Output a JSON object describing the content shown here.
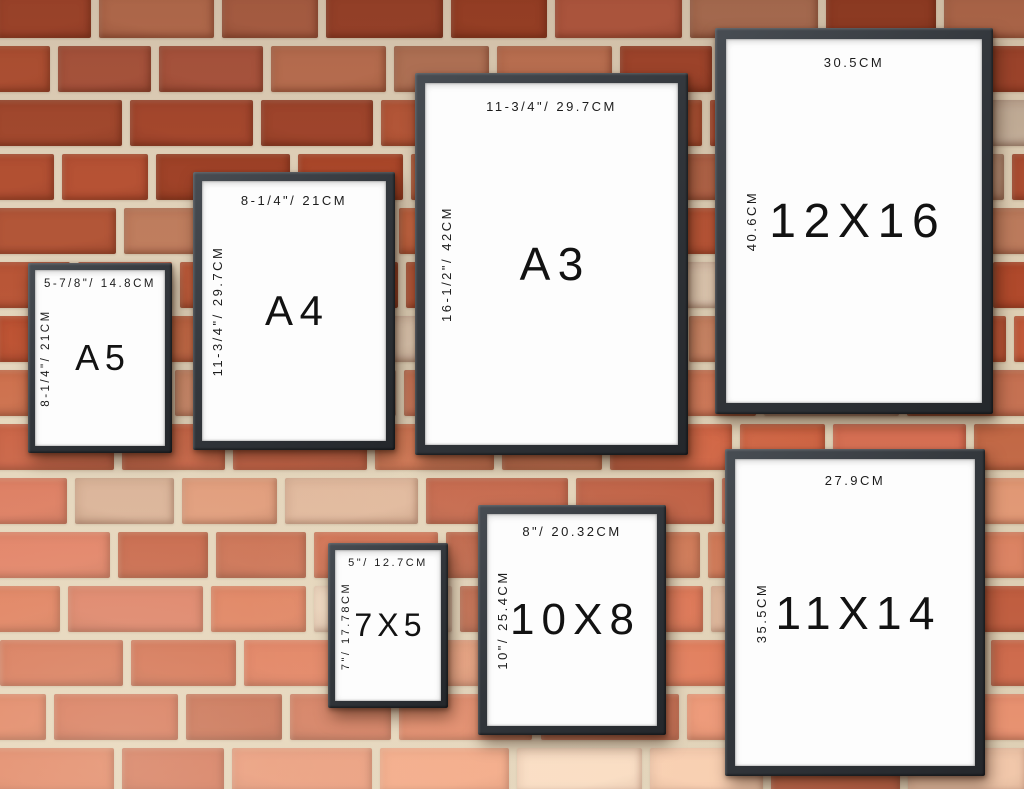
{
  "scene": {
    "type": "picture-frame-size-comparison-chart",
    "background": "red brick wall",
    "colors": {
      "brick": "#c45f3e",
      "mortar": "#e4d6bf",
      "frame": "#33373c",
      "paper": "#fdfdfd",
      "text": "#1c1c1c"
    }
  },
  "frames": [
    {
      "id": "A5",
      "label": "A5",
      "top_dimension": "5-7/8\"/ 14.8CM",
      "side_dimension": "8-1/4\"/ 21CM"
    },
    {
      "id": "A4",
      "label": "A4",
      "top_dimension": "8-1/4\"/ 21CM",
      "side_dimension": "11-3/4\"/ 29.7CM"
    },
    {
      "id": "A3",
      "label": "A3",
      "top_dimension": "11-3/4\"/ 29.7CM",
      "side_dimension": "16-1/2\"/ 42CM"
    },
    {
      "id": "12X16",
      "label": "12X16",
      "top_dimension": "30.5CM",
      "side_dimension": "40.6CM"
    },
    {
      "id": "7X5",
      "label": "7X5",
      "top_dimension": "5\"/ 12.7CM",
      "side_dimension": "7\"/ 17.78CM"
    },
    {
      "id": "10X8",
      "label": "10X8",
      "top_dimension": "8\"/ 20.32CM",
      "side_dimension": "10\"/ 25.4CM"
    },
    {
      "id": "11X14",
      "label": "11X14",
      "top_dimension": "27.9CM",
      "side_dimension": "35.5CM"
    }
  ]
}
